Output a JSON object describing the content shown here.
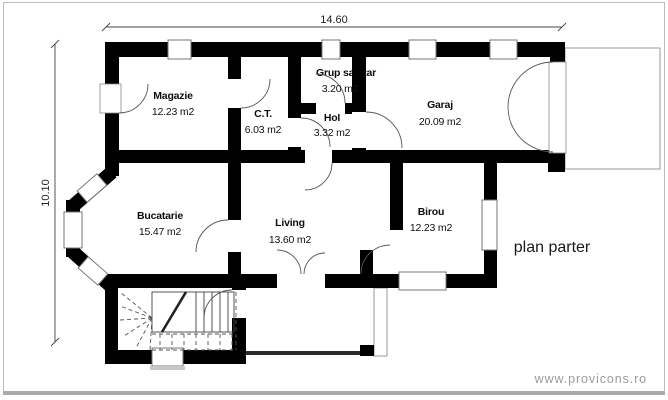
{
  "plan": {
    "title": "plan parter",
    "watermark": "www.provicons.ro",
    "dimensions": {
      "width_label": "14.60",
      "height_label": "10.10"
    },
    "rooms": [
      {
        "name": "Magazie",
        "area": "12.23 m2"
      },
      {
        "name": "C.T.",
        "area": "6.03 m2"
      },
      {
        "name": "Grup sanitar",
        "area": "3.20 m2"
      },
      {
        "name": "Hol",
        "area": "3.32 m2"
      },
      {
        "name": "Garaj",
        "area": "20.09 m2"
      },
      {
        "name": "Bucatarie",
        "area": "15.47 m2"
      },
      {
        "name": "Living",
        "area": "13.60 m2"
      },
      {
        "name": "Birou",
        "area": "12.23 m2"
      }
    ]
  }
}
